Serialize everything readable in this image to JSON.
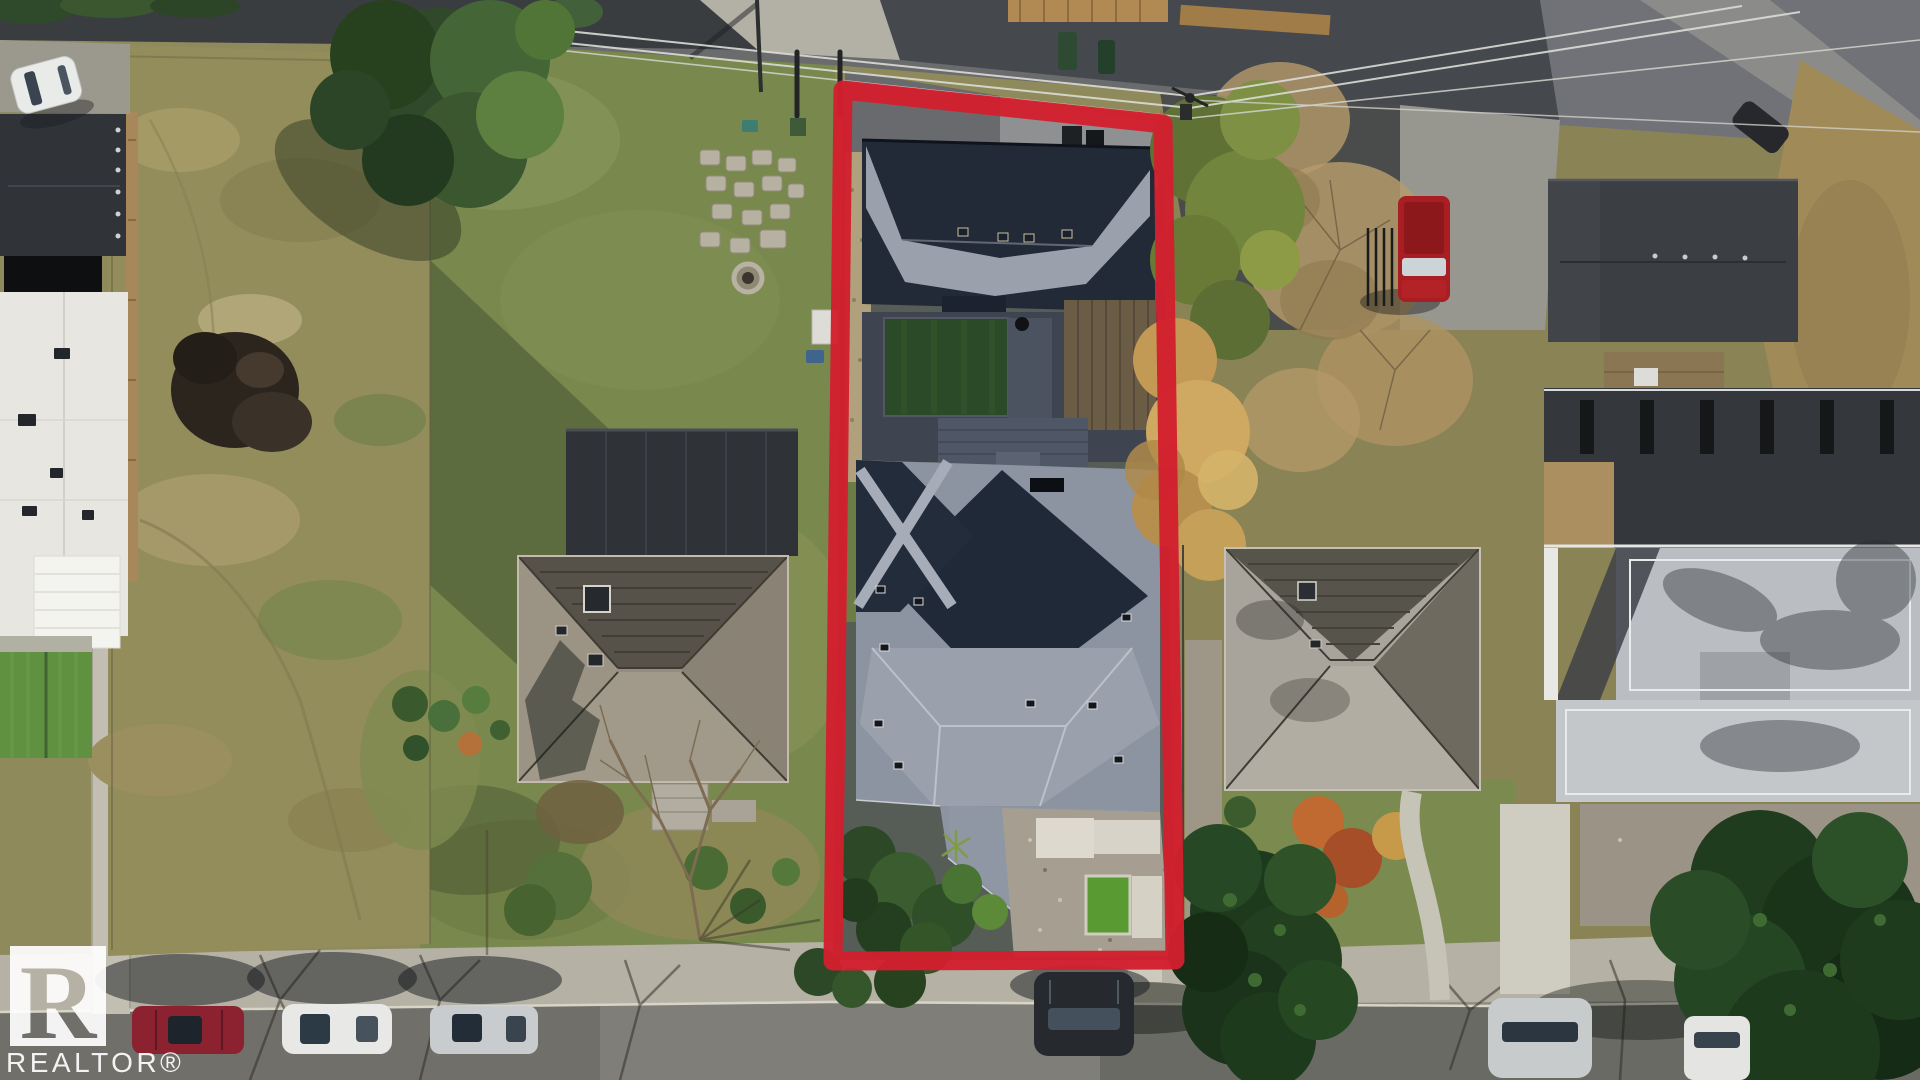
{
  "meta": {
    "type": "aerial-drone-photo",
    "subject": "Top-down aerial view of a residential lot highlighted with a red boundary outline",
    "season": "autumn",
    "view": "top-down"
  },
  "annotation": {
    "outline_color": "#d21f2e"
  },
  "watermark": {
    "logo_letter": "R",
    "label": "REALTOR®"
  },
  "scene": {
    "top": "back alley with power lines, utility pole, wood fences and garbage bins",
    "bottom": "residential street with sidewalk and parked cars",
    "left": "white multi-unit building and vacant scrub lot with dirt pile",
    "center_left": "neighbour house with taupe hip roof, backyard lawn, stone pavers and fire pit",
    "subject_property": "modern home with charcoal cross-hip roof, detached garage, artificial turf backyard and landscaped front yard",
    "right": "neighbour house with grey hip roof, autumn trees, red pickup truck, modern flat-roof house with roof decks and large conifers"
  },
  "palette": {
    "outline_red": "#d21f2e",
    "asphalt": "#55565a",
    "concrete": "#b5b1a4",
    "scrub_tan": "#938d5c",
    "lawn_green": "#79884d",
    "turf_green": "#5a9a33",
    "roof_charcoal": "#1f2937",
    "roof_light": "#9aa1ad",
    "roof_taupe": "#948c7e",
    "conifer_green": "#1e3a1d",
    "autumn_gold": "#c9a55b",
    "truck_red": "#a91e22",
    "watermark_white": "#ffffff"
  }
}
